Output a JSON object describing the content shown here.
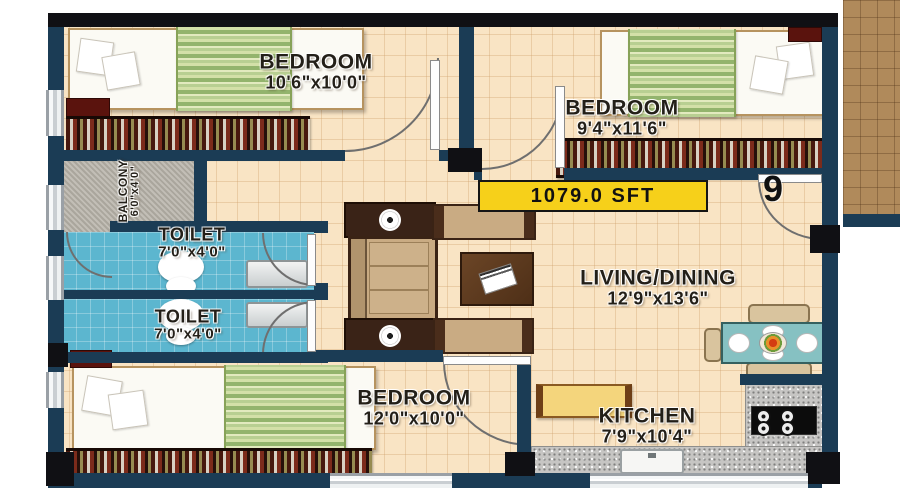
{
  "plan": {
    "area_badge": "1079.0 SFT",
    "unit_number": "9"
  },
  "rooms": {
    "bedroom_top_left": {
      "label": "BEDROOM",
      "dims": "10'6\"x10'0\""
    },
    "bedroom_top_right": {
      "label": "BEDROOM",
      "dims": "9'4\"x11'6\""
    },
    "balcony": {
      "label": "BALCONY",
      "dims": "6'0\"x4'0\""
    },
    "toilet_upper": {
      "label": "TOILET",
      "dims": "7'0\"x4'0\""
    },
    "toilet_lower": {
      "label": "TOILET",
      "dims": "7'0\"x4'0\""
    },
    "living_dining": {
      "label": "LIVING/DINING",
      "dims": "12'9\"x13'6\""
    },
    "bedroom_bottom": {
      "label": "BEDROOM",
      "dims": "12'0\"x10'0\""
    },
    "kitchen": {
      "label": "KITCHEN",
      "dims": "7'9\"x10'4\""
    }
  },
  "colors": {
    "wall_navy": "#1b3c55",
    "wall_black": "#101014",
    "floor_tile": "#f9e4c4",
    "toilet_floor": "#5cb6cf",
    "balcony_floor": "#b9b5ac",
    "corridor_tile": "#b08a5b",
    "badge_yellow": "#f6d01a"
  }
}
